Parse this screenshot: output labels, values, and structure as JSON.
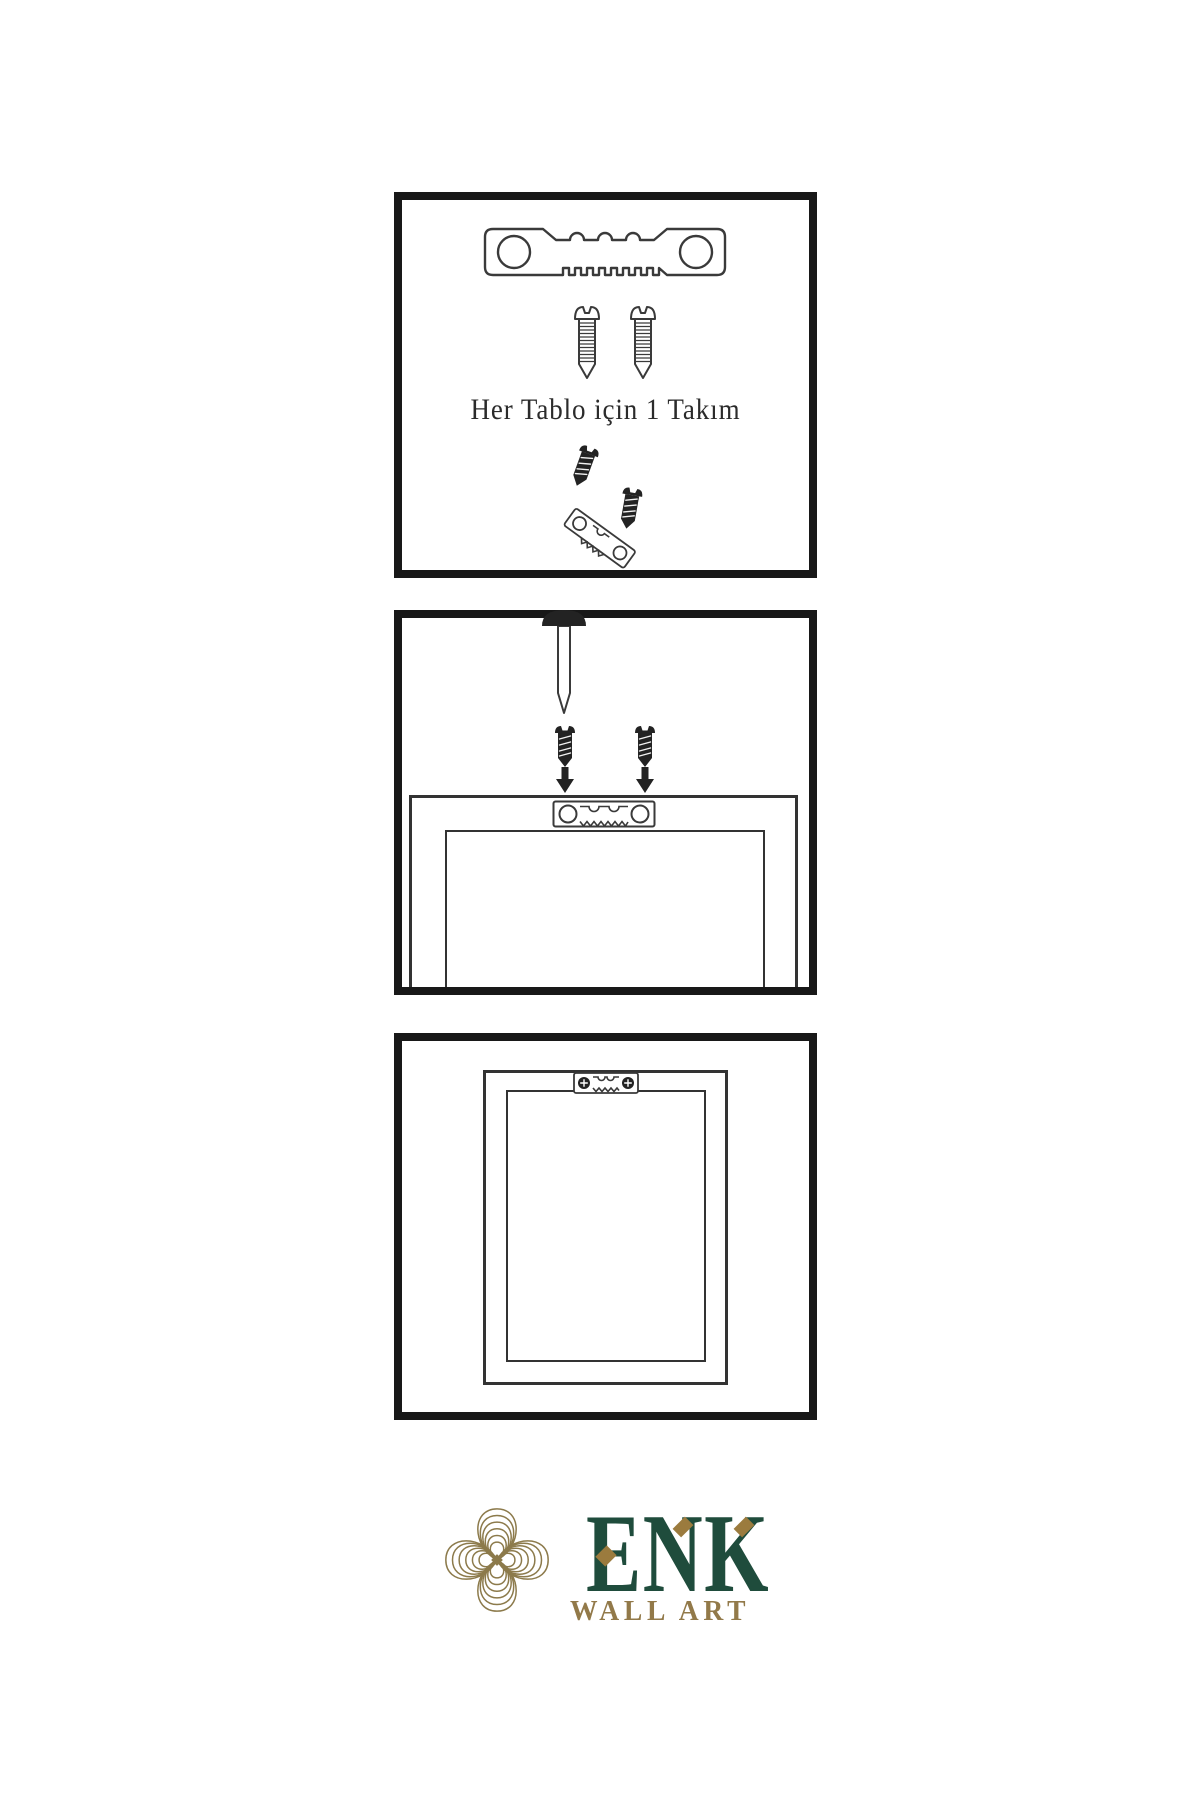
{
  "colors": {
    "panel_border": "#181818",
    "line": "#3a3a3a",
    "ink": "#232323",
    "brand_green": "#1f4c3c",
    "brand_gold": "#927949",
    "knot_gold": "#8c7a4b",
    "diamond_gold": "#9b7b3e"
  },
  "steps": [
    {
      "id": "hardware-kit",
      "caption": "Her Tablo için 1 Takım",
      "items": [
        "sawtooth-hanger",
        "screw",
        "screw",
        "hanger-with-screws"
      ]
    },
    {
      "id": "mark-and-screw",
      "items": [
        "nail",
        "screw",
        "screw",
        "down-arrow",
        "down-arrow",
        "frame-back",
        "sawtooth-hanger"
      ]
    },
    {
      "id": "hanger-installed",
      "items": [
        "frame-back",
        "sawtooth-hanger-with-screws"
      ]
    }
  ],
  "logo": {
    "brand": "ENK",
    "tagline": "WALL ART"
  }
}
